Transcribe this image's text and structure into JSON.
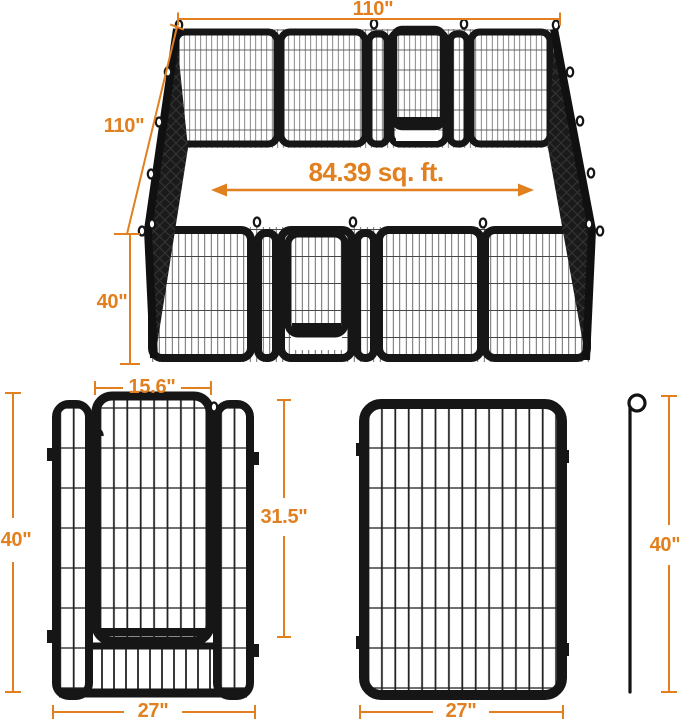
{
  "diagram": {
    "title_hint": "pet playpen dimension diagram",
    "pen_3d_view": {
      "top_width": "110\"",
      "depth": "110\"",
      "height": "40\"",
      "area": "84.39 sq. ft."
    },
    "door_panel_view": {
      "door_width": "15.6\"",
      "door_height": "31.5\"",
      "panel_height": "40\"",
      "panel_width": "27\""
    },
    "plain_panel_view": {
      "panel_width": "27\"",
      "stake_height": "40\""
    },
    "icons": {
      "ground_stake": "shepherd-hook-stake",
      "tie_hook": "wire-loop"
    },
    "colors": {
      "accent_orange": "#E27F1E",
      "frame_black": "#161616",
      "mesh_gray": "#4a4a4a",
      "background": "#ffffff"
    }
  }
}
